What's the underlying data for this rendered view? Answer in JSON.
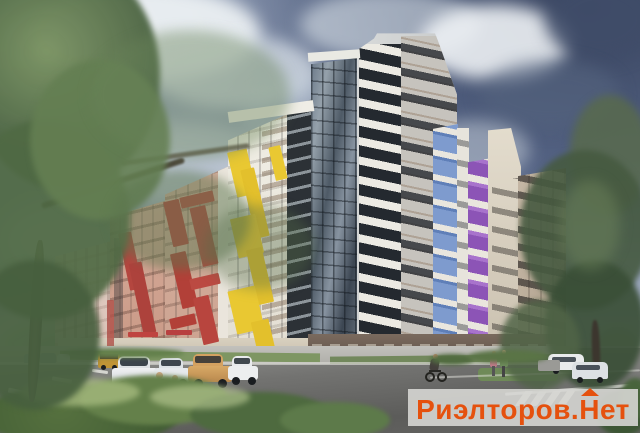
{
  "scene": {
    "alt": "Architectural rendering of a multi-storey apartment complex with red, yellow, blue and purple balcony accents, street with parked cars, pedestrians, a cyclist and trees",
    "watermark": {
      "part1": "Риэлторов.",
      "part2": "Н",
      "part3": "ет",
      "text_color": "#e5510e",
      "band_color": "#d6d6d3"
    },
    "palette": {
      "sky": "#56678c",
      "cloud_white": "#eef2f4",
      "cloud_dark": "#3f4c68",
      "facade_white": "#efece4",
      "facade_beige": "#cfa493",
      "facade_pink": "#d9b2a2",
      "facade_gray": "#c6c3bd",
      "facade_tan": "#c2b4a2",
      "accent_red": "#b8453e",
      "accent_yellow": "#e9c832",
      "accent_blue": "#7e9bce",
      "accent_purple": "#8c54b6",
      "glass_shaft": "#4e5a66",
      "ground_brick": "#5d4f45",
      "road": "#6b6b69",
      "grass": "#7e9663",
      "tree_green": "#4f6a44"
    }
  }
}
